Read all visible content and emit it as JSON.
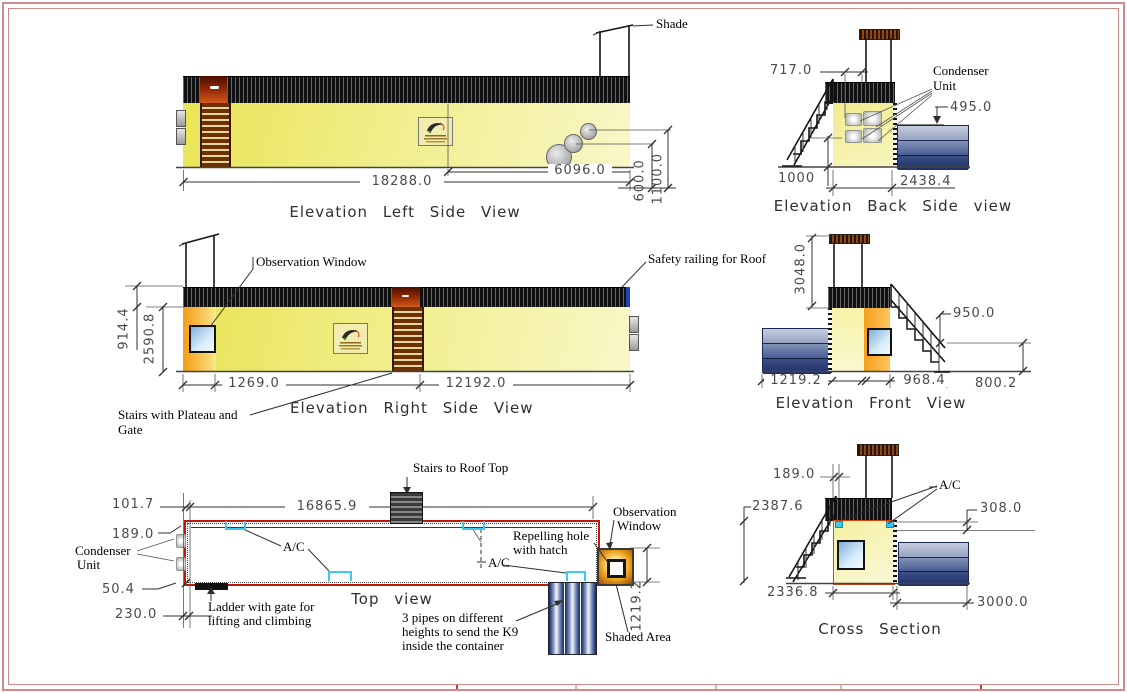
{
  "views": {
    "left_side": {
      "title": "Elevation Left Side View",
      "shade_label": "Shade",
      "dim_width_total": "18288.0",
      "dim_width_right": "6096.0",
      "dim_pipe_low": "600.0",
      "dim_pipe_high": "1100.0"
    },
    "back_side": {
      "title": "Elevation Back Side view",
      "condenser_label_1": "Condenser",
      "condenser_label_2": "Unit",
      "dim_shade_offset": "717.0",
      "dim_box_height": "495.0",
      "dim_platform": "1000",
      "dim_width": "2438.4"
    },
    "right_side": {
      "title": "Elevation Right Side View",
      "observation_label": "Observation Window",
      "railing_label": "Safety railing for Roof",
      "stairs_label_1": "Stairs with Plateau and",
      "stairs_label_2": "Gate",
      "dim_rail_height": "914.4",
      "dim_height": "2590.8",
      "dim_left": "1269.0",
      "dim_right": "12192.0"
    },
    "front": {
      "title": "Elevation Front View",
      "dim_height": "3048.0",
      "dim_rail": "950.0",
      "dim_shaded": "1219.2",
      "dim_stairs": "968.4",
      "dim_ground": "800.2"
    },
    "top": {
      "title": "Top view",
      "dim_offset": "101.7",
      "dim_length": "16865.9",
      "dim_wall": "189.0",
      "dim_small": "50.4",
      "dim_edge": "230.0",
      "dim_shaded": "1219.2",
      "condenser_label_1": "Condenser",
      "condenser_label_2": "Unit",
      "stairs_label": "Stairs to Roof Top",
      "ladder_label_1": "Ladder with gate for",
      "ladder_label_2": "lifting and climbing",
      "ac_label_1": "A/C",
      "ac_label_2": "A/C",
      "repelling_label_1": "Repelling hole",
      "repelling_label_2": "with hatch",
      "observation_label_1": "Observation",
      "observation_label_2": "Window",
      "pipes_label_1": "3 pipes on different",
      "pipes_label_2": "heights to send the K9",
      "pipes_label_3": "inside the container",
      "shaded_label": "Shaded Area"
    },
    "cross": {
      "title": "Cross Section",
      "ac_label": "A/C",
      "dim_wall": "189.0",
      "dim_inner_height": "2387.6",
      "dim_gap": "308.0",
      "dim_inner_width": "2336.8",
      "dim_shaded_width": "3000.0"
    }
  },
  "colors": {
    "frame_pink": "#cf8a8a",
    "container_yellow": "#ece764",
    "plan_border_red": "#c21807",
    "ac_cyan": "#3cc9ef"
  }
}
